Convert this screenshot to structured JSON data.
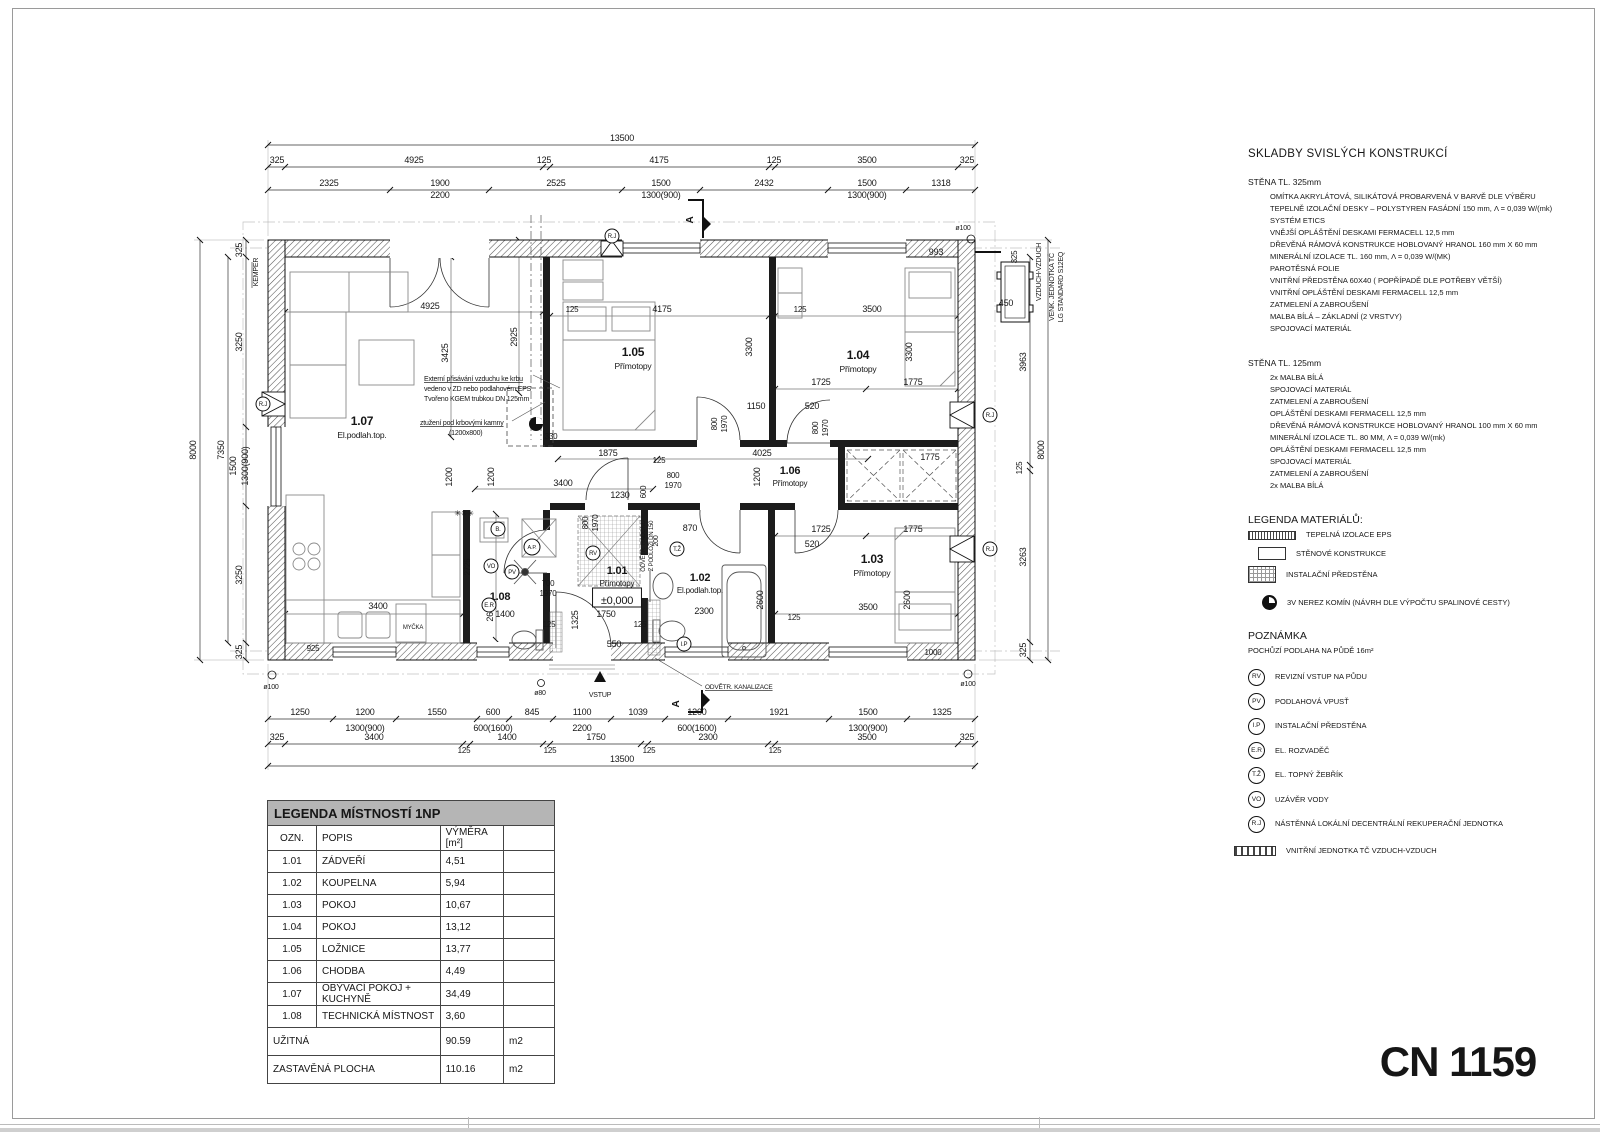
{
  "page": {
    "sheet_code": "CN 1159"
  },
  "right_panel": {
    "title": "SKLADBY SVISLÝCH KONSTRUKCÍ",
    "wall325": {
      "heading": "STĚNA TL. 325mm",
      "lines": [
        "OMÍTKA AKRYLÁTOVÁ, SILIKÁTOVÁ PROBARVENÁ V BARVĚ DLE VÝBĚRU",
        "TEPELNĚ IZOLAČNÍ DESKY – POLYSTYREN FASÁDNÍ 150 mm, Λ = 0,039 W/(mk) SYSTÉM ETICS",
        "VNĚJŠÍ OPLÁŠTĚNÍ DESKAMI FERMACELL 12,5 mm",
        "DŘEVĚNÁ RÁMOVÁ KONSTRUKCE HOBLOVANÝ HRANOL 160 mm X 60 mm",
        "MINERÁLNÍ IZOLACE TL. 160 mm, Λ = 0,039 W/(MK)",
        "PAROTĚSNÁ FOLIE",
        "VNITŘNÍ PŘEDSTĚNA 60X40 ( POPŘÍPADĚ DLE POTŘEBY VĚTŠÍ)",
        "VNITŘNÍ OPLÁŠTĚNÍ DESKAMI FERMACELL 12,5 mm",
        "ZATMELENÍ A ZABROUŠENÍ",
        "MALBA BÍLÁ – ZÁKLADNÍ (2 VRSTVY)",
        "SPOJOVACÍ MATERIÁL"
      ]
    },
    "wall125": {
      "heading": "STĚNA TL. 125mm",
      "lines": [
        "2x MALBA BÍLÁ",
        "SPOJOVACÍ MATERIÁL",
        "ZATMELENÍ A ZABROUŠENÍ",
        "OPLÁŠTĚNÍ DESKAMI FERMACELL 12,5 mm",
        "DŘEVĚNÁ RÁMOVÁ KONSTRUKCE HOBLOVANÝ HRANOL 100 mm X 60 mm",
        "MINERÁLNÍ IZOLACE TL. 80 MM, Λ = 0,039 W/(mk)",
        "OPLÁŠTĚNÍ DESKAMI FERMACELL 12,5 mm",
        "SPOJOVACÍ MATERIÁL",
        "ZATMELENÍ A ZABROUŠENÍ",
        "2x MALBA BÍLÁ"
      ]
    },
    "materials": {
      "heading": "LEGENDA MATERIÁLŮ:",
      "items": [
        {
          "cls": "sw-eps",
          "label": "TEPELNÁ IZOLACE EPS"
        },
        {
          "cls": "sw-wall",
          "label": "STĚNOVÉ KONSTRUKCE"
        },
        {
          "cls": "sw-grid",
          "label": "INSTALAČNÍ PŘEDSTĚNA"
        },
        {
          "cls": "sw-chimney",
          "label": "3V NEREZ KOMÍN (NÁVRH DLE VÝPOČTU SPALINOVÉ CESTY)"
        }
      ]
    },
    "note": {
      "heading": "POZNÁMKA",
      "line": "POCHŮZÍ PODLAHA NA PŮDĚ 16m²"
    },
    "symbols": [
      {
        "code": "RV",
        "label": "REVIZNÍ VSTUP NA PŮDU"
      },
      {
        "code": "PV",
        "label": "PODLAHOVÁ VPUSŤ"
      },
      {
        "code": "I.P",
        "label": "INSTALAČNÍ PŘEDSTĚNA"
      },
      {
        "code": "E.R",
        "label": "EL. ROZVADĚČ"
      },
      {
        "code": "T.Ž",
        "label": "EL. TOPNÝ ŽEBŘÍK"
      },
      {
        "code": "VO",
        "label": "UZÁVĚR VODY"
      },
      {
        "code": "R.J",
        "label": "NÁSTĚNNÁ LOKÁLNÍ DECENTRÁLNÍ REKUPERAČNÍ JEDNOTKA"
      }
    ],
    "hp_unit_label": "VNITŘNÍ JEDNOTKA TČ VZDUCH-VZDUCH"
  },
  "legend_table": {
    "title": "LEGENDA MÍSTNOSTÍ 1NP",
    "col_ozn": "OZN.",
    "col_popis": "POPIS",
    "col_vymera": "VÝMĚRA [m²]",
    "rows": [
      {
        "ozn": "1.01",
        "popis": "ZÁDVEŘÍ",
        "vym": "4,51"
      },
      {
        "ozn": "1.02",
        "popis": "KOUPELNA",
        "vym": "5,94"
      },
      {
        "ozn": "1.03",
        "popis": "POKOJ",
        "vym": "10,67"
      },
      {
        "ozn": "1.04",
        "popis": "POKOJ",
        "vym": "13,12"
      },
      {
        "ozn": "1.05",
        "popis": "LOŽNICE",
        "vym": "13,77"
      },
      {
        "ozn": "1.06",
        "popis": "CHODBA",
        "vym": "4,49"
      },
      {
        "ozn": "1.07",
        "popis": "OBÝVACÍ POKOJ + KUCHYNĚ",
        "vym": "34,49"
      },
      {
        "ozn": "1.08",
        "popis": "TECHNICKÁ MÍSTNOST",
        "vym": "3,60"
      }
    ],
    "totals": [
      {
        "label": "UŽITNÁ",
        "value": "90.59",
        "unit": "m2"
      },
      {
        "label": "ZASTAVĚNÁ PLOCHA",
        "value": "110.16",
        "unit": "m2"
      }
    ]
  },
  "plan": {
    "labels": [
      {
        "t": "13500",
        "x": 622,
        "y": 141
      },
      {
        "t": "325",
        "x": 277,
        "y": 163
      },
      {
        "t": "4925",
        "x": 414,
        "y": 163
      },
      {
        "t": "125",
        "x": 544,
        "y": 163
      },
      {
        "t": "4175",
        "x": 659,
        "y": 163
      },
      {
        "t": "125",
        "x": 774,
        "y": 163
      },
      {
        "t": "3500",
        "x": 867,
        "y": 163
      },
      {
        "t": "325",
        "x": 967,
        "y": 163
      },
      {
        "t": "2325",
        "x": 329,
        "y": 186
      },
      {
        "t": "1900",
        "x": 440,
        "y": 186
      },
      {
        "t": "2200",
        "x": 440,
        "y": 198
      },
      {
        "t": "2525",
        "x": 556,
        "y": 186
      },
      {
        "t": "1500",
        "x": 661,
        "y": 186
      },
      {
        "t": "1300(900)",
        "x": 661,
        "y": 198
      },
      {
        "t": "2432",
        "x": 764,
        "y": 186
      },
      {
        "t": "1500",
        "x": 867,
        "y": 186
      },
      {
        "t": "1300(900)",
        "x": 867,
        "y": 198
      },
      {
        "t": "1318",
        "x": 941,
        "y": 186
      },
      {
        "t": "1250",
        "x": 300,
        "y": 715
      },
      {
        "t": "1200",
        "x": 365,
        "y": 715
      },
      {
        "t": "1300(900)",
        "x": 365,
        "y": 731
      },
      {
        "t": "1550",
        "x": 437,
        "y": 715
      },
      {
        "t": "600",
        "x": 493,
        "y": 715
      },
      {
        "t": "600(1600)",
        "x": 493,
        "y": 731
      },
      {
        "t": "845",
        "x": 532,
        "y": 715
      },
      {
        "t": "1100",
        "x": 582,
        "y": 715
      },
      {
        "t": "2200",
        "x": 582,
        "y": 731
      },
      {
        "t": "1039",
        "x": 638,
        "y": 715
      },
      {
        "t": "1200",
        "x": 697,
        "y": 715
      },
      {
        "t": "600(1600)",
        "x": 697,
        "y": 731
      },
      {
        "t": "1921",
        "x": 779,
        "y": 715
      },
      {
        "t": "1500",
        "x": 868,
        "y": 715
      },
      {
        "t": "1300(900)",
        "x": 868,
        "y": 731
      },
      {
        "t": "1325",
        "x": 942,
        "y": 715
      },
      {
        "t": "325",
        "x": 277,
        "y": 740
      },
      {
        "t": "3400",
        "x": 374,
        "y": 740
      },
      {
        "t": "125",
        "x": 464,
        "y": 753,
        "s": 8
      },
      {
        "t": "1400",
        "x": 507,
        "y": 740
      },
      {
        "t": "125",
        "x": 550,
        "y": 753,
        "s": 8
      },
      {
        "t": "1750",
        "x": 596,
        "y": 740
      },
      {
        "t": "125",
        "x": 649,
        "y": 753,
        "s": 8
      },
      {
        "t": "2300",
        "x": 708,
        "y": 740
      },
      {
        "t": "125",
        "x": 775,
        "y": 753,
        "s": 8
      },
      {
        "t": "3500",
        "x": 867,
        "y": 740
      },
      {
        "t": "325",
        "x": 967,
        "y": 740
      },
      {
        "t": "13500",
        "x": 622,
        "y": 762
      },
      {
        "t": "8000",
        "x": 196,
        "y": 450,
        "r": 1
      },
      {
        "t": "7350",
        "x": 224,
        "y": 450,
        "r": 1
      },
      {
        "t": "325",
        "x": 242,
        "y": 250,
        "r": 1
      },
      {
        "t": "3250",
        "x": 242,
        "y": 342,
        "r": 1
      },
      {
        "t": "1500",
        "x": 236,
        "y": 466,
        "r": 1
      },
      {
        "t": "1300(900)",
        "x": 248,
        "y": 466,
        "r": 1
      },
      {
        "t": "3250",
        "x": 242,
        "y": 575,
        "r": 1
      },
      {
        "t": "325",
        "x": 242,
        "y": 652,
        "r": 1
      },
      {
        "t": "KEMPER",
        "x": 258,
        "y": 272,
        "r": 1,
        "s": 7
      },
      {
        "t": "8000",
        "x": 1044,
        "y": 450,
        "r": 1
      },
      {
        "t": "3963",
        "x": 1026,
        "y": 362,
        "r": 1
      },
      {
        "t": "125",
        "x": 1022,
        "y": 468,
        "r": 1,
        "s": 8
      },
      {
        "t": "3263",
        "x": 1026,
        "y": 557,
        "r": 1
      },
      {
        "t": "325",
        "x": 1026,
        "y": 650,
        "r": 1
      },
      {
        "t": "993",
        "x": 936,
        "y": 255
      },
      {
        "t": "450",
        "x": 1006,
        "y": 306
      },
      {
        "t": "325",
        "x": 1017,
        "y": 257,
        "r": 1,
        "s": 8
      },
      {
        "t": "VZDUCH-VZDUCH",
        "x": 1041,
        "y": 272,
        "r": 1,
        "s": 7
      },
      {
        "t": "VENK. JEDNOTKA TČ",
        "x": 1054,
        "y": 287,
        "r": 1,
        "s": 7
      },
      {
        "t": "LG STANDARD S12EQ",
        "x": 1063,
        "y": 287,
        "r": 1,
        "s": 7
      },
      {
        "t": "ø100",
        "x": 963,
        "y": 230,
        "s": 7
      },
      {
        "t": "ø100",
        "x": 271,
        "y": 689,
        "s": 7
      },
      {
        "t": "ø100",
        "x": 968,
        "y": 686,
        "s": 7
      },
      {
        "t": "ø80",
        "x": 540,
        "y": 695,
        "s": 7
      },
      {
        "t": "4925",
        "x": 430,
        "y": 309
      },
      {
        "t": "3425",
        "x": 448,
        "y": 353,
        "r": 1
      },
      {
        "t": "2925",
        "x": 517,
        "y": 337,
        "r": 1
      },
      {
        "t": "125",
        "x": 572,
        "y": 312,
        "s": 8
      },
      {
        "t": "4175",
        "x": 662,
        "y": 312
      },
      {
        "t": "125",
        "x": 800,
        "y": 312,
        "s": 8
      },
      {
        "t": "3500",
        "x": 872,
        "y": 312
      },
      {
        "t": "3300",
        "x": 752,
        "y": 347,
        "r": 1
      },
      {
        "t": "3300",
        "x": 912,
        "y": 352,
        "r": 1
      },
      {
        "t": "1725",
        "x": 821,
        "y": 385
      },
      {
        "t": "1775",
        "x": 913,
        "y": 385
      },
      {
        "t": "1150",
        "x": 756,
        "y": 409
      },
      {
        "t": "520",
        "x": 812,
        "y": 409
      },
      {
        "t": "800",
        "x": 717,
        "y": 424,
        "r": 1,
        "s": 8
      },
      {
        "t": "1970",
        "x": 727,
        "y": 424,
        "r": 1,
        "s": 8
      },
      {
        "t": "800",
        "x": 818,
        "y": 428,
        "r": 1,
        "s": 8
      },
      {
        "t": "1970",
        "x": 828,
        "y": 428,
        "r": 1,
        "s": 8
      },
      {
        "t": "330",
        "x": 551,
        "y": 439,
        "s": 8
      },
      {
        "t": "1875",
        "x": 608,
        "y": 456
      },
      {
        "t": "4025",
        "x": 762,
        "y": 456
      },
      {
        "t": "125",
        "x": 659,
        "y": 463,
        "s": 8
      },
      {
        "t": "1200",
        "x": 452,
        "y": 477,
        "r": 1
      },
      {
        "t": "1200",
        "x": 494,
        "y": 477,
        "r": 1
      },
      {
        "t": "1200",
        "x": 760,
        "y": 477,
        "r": 1
      },
      {
        "t": "800",
        "x": 673,
        "y": 478,
        "s": 8
      },
      {
        "t": "1970",
        "x": 673,
        "y": 488,
        "s": 8
      },
      {
        "t": "1775",
        "x": 930,
        "y": 460
      },
      {
        "t": "3400",
        "x": 563,
        "y": 486
      },
      {
        "t": "1230",
        "x": 620,
        "y": 498
      },
      {
        "t": "600",
        "x": 646,
        "y": 492,
        "r": 1,
        "s": 8
      },
      {
        "t": "870",
        "x": 690,
        "y": 531
      },
      {
        "t": "700",
        "x": 548,
        "y": 586,
        "s": 8
      },
      {
        "t": "1970",
        "x": 548,
        "y": 596,
        "s": 8
      },
      {
        "t": "800",
        "x": 588,
        "y": 523,
        "r": 1,
        "s": 8
      },
      {
        "t": "1970",
        "x": 598,
        "y": 523,
        "r": 1,
        "s": 8
      },
      {
        "t": "200",
        "x": 658,
        "y": 541,
        "r": 1,
        "s": 7
      },
      {
        "t": "1725",
        "x": 821,
        "y": 532
      },
      {
        "t": "1775",
        "x": 913,
        "y": 532
      },
      {
        "t": "520",
        "x": 812,
        "y": 547
      },
      {
        "t": "2725",
        "x": 470,
        "y": 567,
        "r": 1,
        "s": 8
      },
      {
        "t": "2600",
        "x": 493,
        "y": 612,
        "r": 1
      },
      {
        "t": "2600",
        "x": 763,
        "y": 600,
        "r": 1
      },
      {
        "t": "2600",
        "x": 910,
        "y": 600,
        "r": 1
      },
      {
        "t": "1325",
        "x": 578,
        "y": 620,
        "r": 1
      },
      {
        "t": "1400",
        "x": 505,
        "y": 617
      },
      {
        "t": "125",
        "x": 549,
        "y": 627,
        "s": 8
      },
      {
        "t": "1750",
        "x": 606,
        "y": 617
      },
      {
        "t": "125",
        "x": 640,
        "y": 627,
        "s": 8
      },
      {
        "t": "550",
        "x": 614,
        "y": 647
      },
      {
        "t": "2300",
        "x": 704,
        "y": 614
      },
      {
        "t": "125",
        "x": 794,
        "y": 620,
        "s": 8
      },
      {
        "t": "3500",
        "x": 868,
        "y": 610
      },
      {
        "t": "1000",
        "x": 933,
        "y": 655,
        "s": 8
      },
      {
        "t": "925",
        "x": 313,
        "y": 651,
        "s": 8
      },
      {
        "t": "3400",
        "x": 378,
        "y": 609
      },
      {
        "t": "MYČKA",
        "x": 413,
        "y": 629,
        "s": 6
      },
      {
        "t": "Externí přisávání vzduchu ke krbu",
        "x": 424,
        "y": 381,
        "s": 7,
        "a": "s",
        "u": 1
      },
      {
        "t": "vedeno v ZD nebo podlahovém EPS",
        "x": 424,
        "y": 391,
        "s": 7,
        "a": "s"
      },
      {
        "t": "Tvořeno  KGEM trubkou DN 125mm",
        "x": 424,
        "y": 401,
        "s": 7,
        "a": "s"
      },
      {
        "t": "ztužení pod krbovými kamny",
        "x": 420,
        "y": 425,
        "s": 7,
        "a": "s",
        "u": 1
      },
      {
        "t": "(1200x800)",
        "x": 449,
        "y": 435,
        "s": 7,
        "a": "s"
      },
      {
        "t": "ODVĚTR. RADONU",
        "x": 645,
        "y": 546,
        "r": 1,
        "s": 6
      },
      {
        "t": "Z PODLOŽÍ DN 150",
        "x": 653,
        "y": 546,
        "r": 1,
        "s": 6
      },
      {
        "t": "ODVĚTR. KANALIZACE",
        "x": 705,
        "y": 689,
        "s": 6.5,
        "u": 1,
        "a": "s"
      },
      {
        "t": "VSTUP",
        "x": 600,
        "y": 697,
        "s": 7,
        "c": "g"
      },
      {
        "t": "✳✳✳",
        "x": 464,
        "y": 516,
        "s": 8
      },
      {
        "t": "A",
        "x": 693,
        "y": 220,
        "r": 1,
        "s": 10,
        "b": 1
      },
      {
        "t": "A",
        "x": 679,
        "y": 704,
        "r": 1,
        "s": 10,
        "b": 1
      },
      {
        "t": "1.05",
        "x": 633,
        "y": 356,
        "b": 1,
        "s": 12
      },
      {
        "t": "Přímotopy",
        "x": 633,
        "y": 369,
        "s": 8.5
      },
      {
        "t": "1.04",
        "x": 858,
        "y": 359,
        "b": 1,
        "s": 12
      },
      {
        "t": "Přímotopy",
        "x": 858,
        "y": 372,
        "s": 8.5
      },
      {
        "t": "1.07",
        "x": 362,
        "y": 425,
        "b": 1,
        "s": 12
      },
      {
        "t": "El.podlah.top.",
        "x": 362,
        "y": 438,
        "s": 8.5
      },
      {
        "t": "1.06",
        "x": 790,
        "y": 474,
        "b": 1,
        "s": 11
      },
      {
        "t": "Přímotopy",
        "x": 790,
        "y": 486,
        "s": 8
      },
      {
        "t": "1.03",
        "x": 872,
        "y": 563,
        "b": 1,
        "s": 12
      },
      {
        "t": "Přímotopy",
        "x": 872,
        "y": 576,
        "s": 8.5
      },
      {
        "t": "1.01",
        "x": 617,
        "y": 574,
        "b": 1,
        "s": 11
      },
      {
        "t": "Přímotopy",
        "x": 617,
        "y": 586,
        "s": 8
      },
      {
        "t": "±0,000",
        "x": 617,
        "y": 604,
        "s": 11,
        "box": 1
      },
      {
        "t": "1.02",
        "x": 700,
        "y": 581,
        "b": 1,
        "s": 11
      },
      {
        "t": "El.podlah.top.",
        "x": 700,
        "y": 593,
        "s": 8
      },
      {
        "t": "1.08",
        "x": 500,
        "y": 600,
        "b": 1,
        "s": 11
      },
      {
        "t": "R.J",
        "x": 612,
        "y": 236,
        "circ": 7,
        "s": 6
      },
      {
        "t": "R.J",
        "x": 263,
        "y": 404,
        "circ": 7,
        "s": 6
      },
      {
        "t": "R.J",
        "x": 990,
        "y": 415,
        "circ": 7,
        "s": 6
      },
      {
        "t": "R.J",
        "x": 990,
        "y": 549,
        "circ": 7,
        "s": 6
      },
      {
        "t": "RV",
        "x": 593,
        "y": 553,
        "circ": 7,
        "s": 6
      },
      {
        "t": "T.Ž",
        "x": 677,
        "y": 549,
        "circ": 7,
        "s": 6
      },
      {
        "t": "I.P",
        "x": 684,
        "y": 644,
        "circ": 7,
        "s": 6
      },
      {
        "t": "VO",
        "x": 491,
        "y": 566,
        "circ": 7,
        "s": 6
      },
      {
        "t": "PV",
        "x": 512,
        "y": 572,
        "circ": 7,
        "s": 6
      },
      {
        "t": "E.R",
        "x": 489,
        "y": 605,
        "circ": 7,
        "s": 6
      },
      {
        "t": "B.",
        "x": 498,
        "y": 529,
        "circ": 7,
        "s": 6
      },
      {
        "t": "A.P.",
        "x": 532,
        "y": 547,
        "circ": 8,
        "s": 5.5
      }
    ]
  }
}
